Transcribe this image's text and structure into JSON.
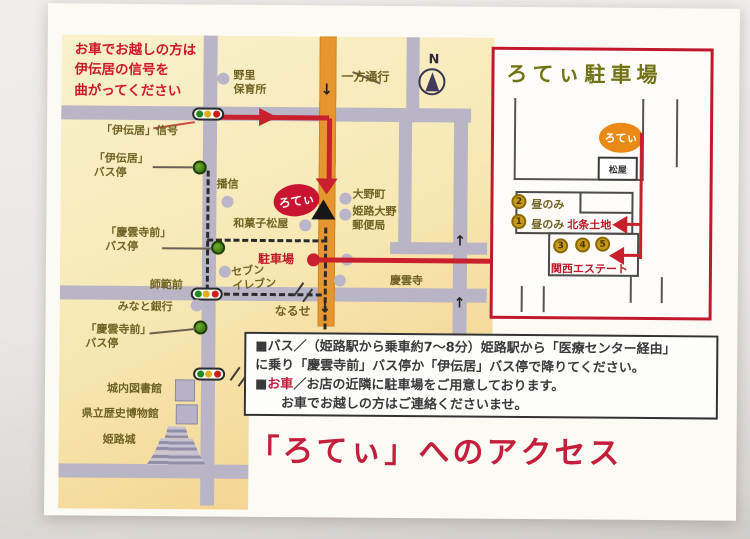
{
  "title": "「ろてぃ」へのアクセス",
  "annotation": "お車でお越しの方は\n伊伝居の信号を\n曲がってください",
  "compass_label": "N",
  "map": {
    "one_way": "一方通行",
    "arrow_down": "↓",
    "arrow_up": "↑",
    "nozato_nursery": "野里\n保育所",
    "ideni_signal": "「伊伝居」信号",
    "ideni_bus_stop": "「伊伝居」\nバス停",
    "banshin": "播信",
    "roti_shop": "ろてぃ",
    "wagashi_matsuya": "和菓子松屋",
    "ohno_cho": "大野町",
    "post_office": "姫路大野\n郵便局",
    "keiunji_mae_bus_stop_1": "「慶雲寺前」\nバス停",
    "parking": "駐車場",
    "seven_eleven": "セブン\nイレブン",
    "shihan_mae": "師範前",
    "minato_bank": "みなと銀行",
    "keiunji_mae_bus_stop_2": "「慶雲寺前」\nバス停",
    "naruse": "なるせ",
    "keiunji_temple": "慶雲寺",
    "jonai_library": "城内図書館",
    "pref_history_museum": "県立歴史博物館",
    "himeji_castle": "姫路城"
  },
  "inset": {
    "title": "ろてぃ駐車場",
    "roti_shop": "ろてぃ",
    "matsuya": "松屋",
    "badge2_num": "2",
    "badge2_text": "昼のみ",
    "badge1_num": "1",
    "badge1_text": "昼のみ",
    "hojo_tochi": "北条土地",
    "spot_nums": [
      "3",
      "4",
      "5"
    ],
    "kansai_estate": "関西エステート"
  },
  "info": {
    "bus_line1": "■バス／（姫路駅から乗車約7～8分）姫路駅から「医療センター経由」",
    "bus_line2": "に乗り「慶雲寺前」バス停か「伊伝居」バス停で降りてください。",
    "car_prefix": "■",
    "car_label": "お車",
    "car_line1": "／お店の近隣に駐車場をご用意しております。",
    "car_line2": "お車でお越しの方はご連絡くださいませ。"
  },
  "colors": {
    "route_red": "#c8202c",
    "accent_red": "#c41e3c",
    "orange_road": "#e5962f",
    "map_label": "#6f6222",
    "inset_oval_orange": "#e98a16"
  }
}
